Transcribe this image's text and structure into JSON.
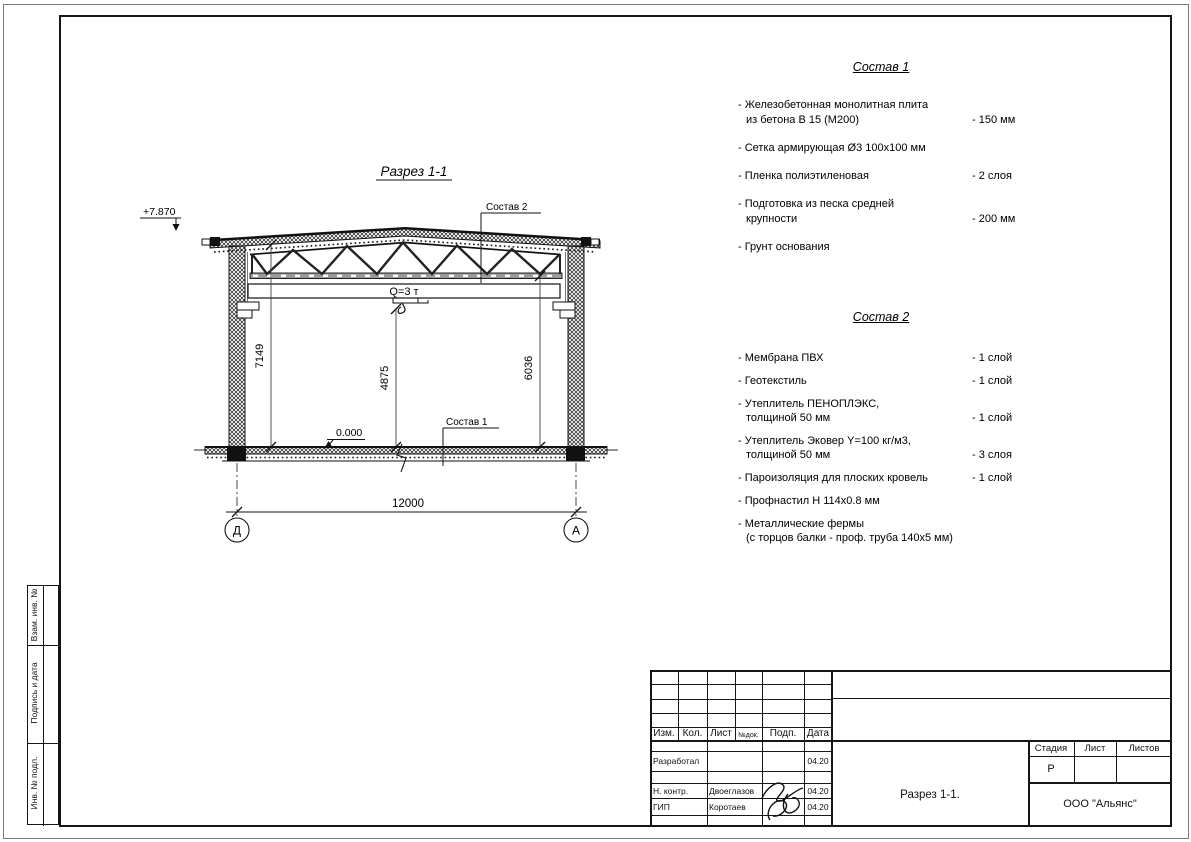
{
  "sheet": {
    "side_stamp": [
      "Взам. инв. №",
      "Подпись и дата",
      "Инв. № подл."
    ]
  },
  "drawing": {
    "title": "Разрез 1-1",
    "elevation_top": "+7.870",
    "elevation_zero": "0.000",
    "crane_capacity": "Q=3 т",
    "callout_roof": "Состав 2",
    "callout_floor": "Состав 1",
    "dim_left": "7149",
    "dim_center": "4875",
    "dim_right": "6036",
    "dim_span": "12000",
    "axis_left": "Д",
    "axis_right": "А"
  },
  "spec1": {
    "title": "Состав 1",
    "items": [
      {
        "line1": "- Железобетонная  монолитная плита",
        "line2": "из бетона В 15 (М200)",
        "value": "- 150 мм"
      },
      {
        "line1": "- Сетка армирующая Ø3 100х100 мм",
        "line2": "",
        "value": ""
      },
      {
        "line1": "- Пленка полиэтиленовая",
        "line2": "",
        "value": "-  2 слоя"
      },
      {
        "line1": "- Подготовка из песка средней",
        "line2": "крупности",
        "value": "- 200 мм"
      },
      {
        "line1": "- Грунт основания",
        "line2": "",
        "value": ""
      }
    ]
  },
  "spec2": {
    "title": "Состав 2",
    "items": [
      {
        "line1": "- Мембрана ПВХ",
        "line2": "",
        "value": "- 1 слой"
      },
      {
        "line1": "- Геотекстиль",
        "line2": "",
        "value": "- 1 слой"
      },
      {
        "line1": "- Утеплитель ПЕНОПЛЭКС,",
        "line2": "толщиной 50 мм",
        "value": "- 1 слой"
      },
      {
        "line1": "- Утеплитель Эковер Y=100 кг/м3,",
        "line2": "толщиной 50 мм",
        "value": "- 3 слоя"
      },
      {
        "line1": "- Пароизоляция для плоских кровель",
        "line2": "",
        "value": "- 1 слой"
      },
      {
        "line1": "- Профнастил Н 114х0.8 мм",
        "line2": "",
        "value": ""
      },
      {
        "line1": "- Металлические фермы",
        "line2": "(с торцов балки - проф. труба 140х5 мм)",
        "value": ""
      }
    ]
  },
  "titleblock": {
    "header": {
      "izm": "Изм.",
      "kol": "Кол.",
      "list": "Лист",
      "ndok": "№док.",
      "podp": "Подп.",
      "data": "Дата"
    },
    "rows": [
      {
        "role": "Разработал",
        "name": "",
        "date": "04.20"
      },
      {
        "role": "Н. контр.",
        "name": "Двоеглазов",
        "date": "04.20"
      },
      {
        "role": "ГИП",
        "name": "Коротаев",
        "date": "04.20"
      }
    ],
    "stage": {
      "label": "Стадия",
      "value": "Р"
    },
    "sheet_col": {
      "label": "Лист",
      "value": ""
    },
    "sheets_col": {
      "label": "Листов",
      "value": ""
    },
    "doc_title": "Разрез 1-1.",
    "company": "ООО \"Альянс\""
  }
}
